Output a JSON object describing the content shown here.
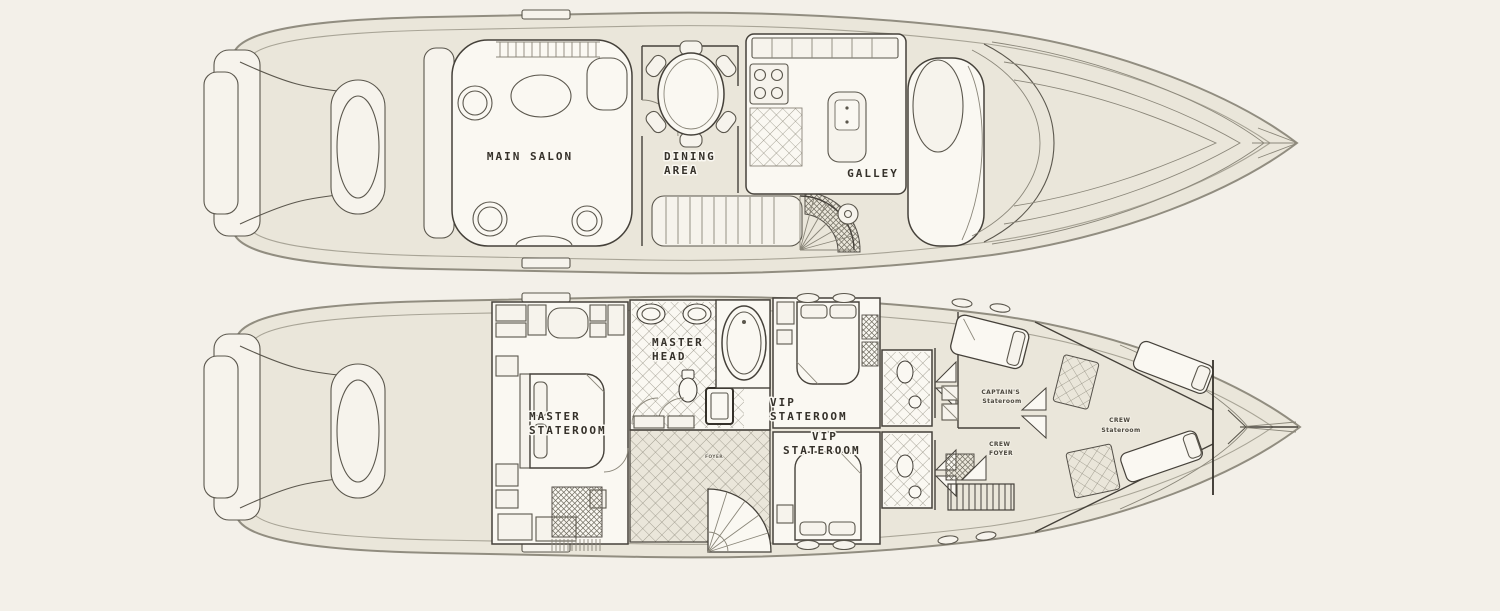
{
  "page": {
    "background_color": "#f3f0e9",
    "figure_type": "yacht-two-deck-floorplan"
  },
  "palette": {
    "deck_fill": "#eae6da",
    "room_fill": "#faf8f2",
    "hull_line": "#918d80",
    "wall_line": "#45413a",
    "label_color": "#35312a"
  },
  "decks": {
    "main": {
      "labels": {
        "main_salon": "MAIN SALON",
        "dining_area": [
          "DINING",
          "AREA"
        ],
        "galley": "GALLEY"
      }
    },
    "lower": {
      "labels": {
        "master_stateroom": [
          "MASTER",
          "STATEROOM"
        ],
        "master_head": [
          "MASTER",
          "HEAD"
        ],
        "vip_stateroom_fwd": [
          "VIP",
          "STATEROOM"
        ],
        "vip_stateroom_mid": [
          "VIP",
          "STATEROOM"
        ],
        "captains_stateroom": [
          "CAPTAIN'S",
          "Stateroom"
        ],
        "crew_foyer": [
          "CREW",
          "FOYER"
        ],
        "crew_stateroom": [
          "CREW",
          "Stateroom"
        ],
        "foyer": "FOYER"
      }
    }
  }
}
